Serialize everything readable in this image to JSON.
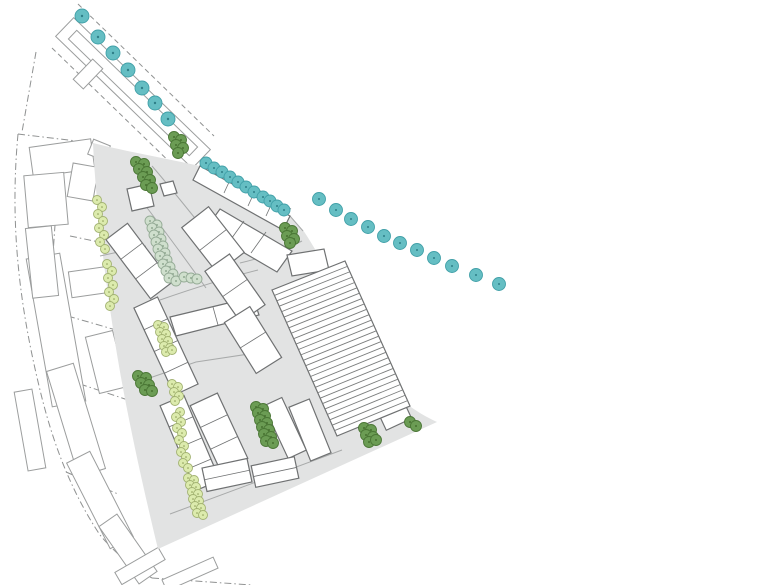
{
  "document": {
    "kind": "architectural-site-plan",
    "canvas": {
      "w": 780,
      "h": 585
    }
  },
  "palette": {
    "background": "#ffffff",
    "site_gray": "#e2e3e3",
    "street_line": "#a8aaaa",
    "context_outline": "#9b9d9d",
    "dash_line": "#8f9191",
    "building_outline": "#6f7172",
    "building_fill": "#ffffff",
    "hatch_line": "#7b7d7d",
    "teal_fill": "#65bec3",
    "teal_stroke": "#41a0a8",
    "teal_dot": "#2f7f88",
    "dark_green_fill": "#6b9c54",
    "dark_green_stroke": "#4a7635",
    "dark_green_dot": "#3c6426",
    "light_green_fill": "#dcead0",
    "light_green_fill2": "#dcebad",
    "light_green_stroke": "#a2b271",
    "light_green_dot": "#8a9a55",
    "sage_fill": "#cfdfcd",
    "sage_stroke": "#95ab96",
    "sage_dot": "#7d997f"
  },
  "plan": {
    "site_path": "M 93,143 C 128,152 165,158 200,166 L 290,216 L 303,230 C 322,258 342,300 360,342 C 374,376 398,404 437,422 L 158,549 C 146,500 128,420 118,360 C 108,300 96,212 93,143 Z",
    "streets": [
      "M 152,166 C 178,196 206,233 232,263",
      "M 132,188 C 158,222 182,254 206,288",
      "M 100,256 L 146,246",
      "M 160,300 C 200,286 230,277 258,270",
      "M 138,382 L 196,362 L 262,352",
      "M 290,216 L 303,231",
      "M 240,263 C 266,257 284,250 302,241",
      "M 170,514 L 342,450"
    ],
    "context": {
      "dashdot": [
        "M 18,134 C 10,220 18,300 40,390 C 52,440 70,490 100,535 C 115,553 132,567 152,578",
        "M 18,134 L 93,143",
        "M 152,578 L 252,585",
        "M 36,52 L 22,132",
        "M 60,152 L 50,298",
        "M 70,236 L 128,248",
        "M 54,312 L 116,330",
        "M 80,384 L 134,402",
        "M 66,472 L 118,494"
      ],
      "dashed": [
        "M 78,4 L 214,136",
        "M 52,48 L 180,172",
        "M 199,155 L 291,209"
      ],
      "rects": [
        {
          "cx": 133,
          "cy": 93,
          "w": 190,
          "h": 26,
          "r": 44
        },
        {
          "cx": 133,
          "cy": 93,
          "w": 168,
          "h": 12,
          "r": 44
        },
        {
          "cx": 88,
          "cy": 74,
          "w": 14,
          "h": 28,
          "r": 44
        },
        {
          "cx": 62,
          "cy": 158,
          "w": 62,
          "h": 30,
          "r": -8
        },
        {
          "cx": 46,
          "cy": 200,
          "w": 40,
          "h": 52,
          "r": -5
        },
        {
          "cx": 83,
          "cy": 182,
          "w": 26,
          "h": 34,
          "r": 10
        },
        {
          "cx": 99,
          "cy": 150,
          "w": 18,
          "h": 16,
          "r": 22
        },
        {
          "cx": 56,
          "cy": 330,
          "w": 34,
          "h": 150,
          "r": -10
        },
        {
          "cx": 42,
          "cy": 262,
          "w": 26,
          "h": 70,
          "r": -6
        },
        {
          "cx": 76,
          "cy": 420,
          "w": 28,
          "h": 110,
          "r": -17
        },
        {
          "cx": 100,
          "cy": 500,
          "w": 26,
          "h": 96,
          "r": -27
        },
        {
          "cx": 128,
          "cy": 549,
          "w": 22,
          "h": 70,
          "r": -35
        },
        {
          "cx": 90,
          "cy": 282,
          "w": 40,
          "h": 26,
          "r": -8
        },
        {
          "cx": 106,
          "cy": 362,
          "w": 28,
          "h": 58,
          "r": -14
        },
        {
          "cx": 140,
          "cy": 566,
          "w": 50,
          "h": 14,
          "r": -30
        },
        {
          "cx": 190,
          "cy": 574,
          "w": 56,
          "h": 12,
          "r": -24
        },
        {
          "cx": 30,
          "cy": 430,
          "w": 18,
          "h": 80,
          "r": -10
        }
      ]
    },
    "buildings": [
      {
        "kind": "poly",
        "points": "200,166 290,216 283,230 193,180",
        "lines": [
          [
            230,
            180,
            224,
            193
          ],
          [
            254,
            193,
            248,
            206
          ],
          [
            272,
            203,
            266,
            216
          ]
        ]
      },
      {
        "kind": "poly",
        "points": "220,209 292,251 277,272 205,230",
        "lines": [
          [
            244,
            221,
            229,
            242
          ],
          [
            266,
            232,
            251,
            253
          ]
        ]
      },
      {
        "kind": "poly",
        "points": "127,189 149,184 154,206 132,211",
        "lines": []
      },
      {
        "kind": "poly",
        "points": "160,184 173,181 177,193 164,196",
        "lines": []
      },
      {
        "kind": "poly",
        "points": "170,317 253,297 259,315 176,336",
        "lines": [
          [
            213,
            307,
            218,
            325
          ]
        ]
      },
      {
        "kind": "poly",
        "points": "287,255 324,249 329,270 292,276",
        "lines": []
      },
      {
        "kind": "rect",
        "cx": 139,
        "cy": 261,
        "w": 27,
        "h": 74,
        "r": -37,
        "div": 2
      },
      {
        "kind": "rect",
        "cx": 166,
        "cy": 346,
        "w": 26,
        "h": 96,
        "r": -25,
        "div": 3
      },
      {
        "kind": "rect",
        "cx": 190,
        "cy": 443,
        "w": 26,
        "h": 92,
        "r": -23,
        "div": 3
      },
      {
        "kind": "rect",
        "cx": 213,
        "cy": 240,
        "w": 34,
        "h": 58,
        "r": -38,
        "div": 1
      },
      {
        "kind": "rect",
        "cx": 235,
        "cy": 288,
        "w": 30,
        "h": 62,
        "r": -35,
        "div": 1
      },
      {
        "kind": "rect",
        "cx": 253,
        "cy": 340,
        "w": 30,
        "h": 60,
        "r": -32,
        "div": 1
      },
      {
        "kind": "rect",
        "cx": 219,
        "cy": 432,
        "w": 30,
        "h": 72,
        "r": -25,
        "div": 2
      },
      {
        "kind": "rect",
        "cx": 285,
        "cy": 428,
        "w": 20,
        "h": 58,
        "r": -25,
        "div": 0
      },
      {
        "kind": "rect",
        "cx": 227,
        "cy": 475,
        "w": 46,
        "h": 24,
        "r": -12,
        "div": 1
      },
      {
        "kind": "rect",
        "cx": 275,
        "cy": 472,
        "w": 44,
        "h": 22,
        "r": -12,
        "div": 1
      },
      {
        "kind": "rect",
        "cx": 310,
        "cy": 430,
        "w": 22,
        "h": 58,
        "r": -22,
        "div": 0
      },
      {
        "kind": "rect",
        "cx": 396,
        "cy": 418,
        "w": 28,
        "h": 14,
        "r": -25,
        "div": 0
      }
    ],
    "hall": {
      "left_edge": [
        [
          272,
          290
        ],
        [
          337,
          436
        ]
      ],
      "right_edge": [
        [
          345,
          261
        ],
        [
          410,
          406
        ]
      ],
      "stripes": 26
    },
    "trees": {
      "teal_street": {
        "r": 7,
        "dot": 1.2,
        "fill": "#65bec3",
        "stroke": "#41a0a8",
        "dotc": "#2f7f88",
        "pts": [
          [
            82,
            16
          ],
          [
            98,
            37
          ],
          [
            113,
            53
          ],
          [
            128,
            70
          ],
          [
            142,
            88
          ],
          [
            155,
            103
          ],
          [
            168,
            119
          ]
        ]
      },
      "teal_row": {
        "r": 6,
        "dot": 1,
        "fill": "#65bec3",
        "stroke": "#41a0a8",
        "dotc": "#2f7f88",
        "pts": [
          [
            206,
            163
          ],
          [
            214,
            168
          ],
          [
            222,
            172
          ],
          [
            230,
            177
          ],
          [
            238,
            182
          ],
          [
            246,
            187
          ],
          [
            254,
            192
          ],
          [
            263,
            197
          ],
          [
            270,
            201
          ],
          [
            277,
            206
          ],
          [
            284,
            210
          ]
        ]
      },
      "teal_arc": {
        "r": 6.5,
        "dot": 1,
        "fill": "#65bec3",
        "stroke": "#41a0a8",
        "dotc": "#2f7f88",
        "pts": [
          [
            319,
            199
          ],
          [
            336,
            210
          ],
          [
            351,
            219
          ],
          [
            368,
            227
          ],
          [
            384,
            236
          ],
          [
            400,
            243
          ],
          [
            417,
            250
          ],
          [
            434,
            258
          ],
          [
            452,
            266
          ],
          [
            476,
            275
          ],
          [
            499,
            284
          ]
        ]
      },
      "dark_green": {
        "r": 5.5,
        "dot": 0.9,
        "fill": "#6b9c54",
        "stroke": "#4a7635",
        "dotc": "#3c6426",
        "pts": [
          [
            174,
            137
          ],
          [
            181,
            140
          ],
          [
            176,
            145
          ],
          [
            183,
            148
          ],
          [
            178,
            153
          ],
          [
            136,
            162
          ],
          [
            144,
            164
          ],
          [
            139,
            169
          ],
          [
            147,
            172
          ],
          [
            143,
            177
          ],
          [
            150,
            180
          ],
          [
            146,
            185
          ],
          [
            152,
            188
          ],
          [
            285,
            228
          ],
          [
            292,
            231
          ],
          [
            287,
            236
          ],
          [
            294,
            239
          ],
          [
            290,
            243
          ],
          [
            138,
            376
          ],
          [
            146,
            378
          ],
          [
            141,
            383
          ],
          [
            149,
            385
          ],
          [
            145,
            390
          ],
          [
            152,
            391
          ],
          [
            256,
            407
          ],
          [
            263,
            409
          ],
          [
            258,
            413
          ],
          [
            265,
            416
          ],
          [
            260,
            420
          ],
          [
            267,
            423
          ],
          [
            262,
            427
          ],
          [
            269,
            430
          ],
          [
            264,
            434
          ],
          [
            271,
            437
          ],
          [
            266,
            441
          ],
          [
            273,
            443
          ],
          [
            364,
            428
          ],
          [
            371,
            430
          ],
          [
            366,
            435
          ],
          [
            373,
            437
          ],
          [
            369,
            442
          ],
          [
            376,
            440
          ],
          [
            410,
            422
          ],
          [
            416,
            426
          ]
        ]
      },
      "light_green": {
        "r": 4.5,
        "dot": 0.8,
        "fill": "#dcebad",
        "stroke": "#a2b271",
        "dotc": "#8a9a55",
        "pts": [
          [
            97,
            200
          ],
          [
            102,
            207
          ],
          [
            98,
            214
          ],
          [
            103,
            221
          ],
          [
            99,
            228
          ],
          [
            104,
            235
          ],
          [
            100,
            242
          ],
          [
            105,
            249
          ],
          [
            107,
            264
          ],
          [
            112,
            271
          ],
          [
            108,
            278
          ],
          [
            113,
            285
          ],
          [
            109,
            292
          ],
          [
            114,
            299
          ],
          [
            110,
            306
          ],
          [
            158,
            325
          ],
          [
            164,
            327
          ],
          [
            160,
            332
          ],
          [
            166,
            334
          ],
          [
            162,
            339
          ],
          [
            168,
            341
          ],
          [
            164,
            346
          ],
          [
            170,
            348
          ],
          [
            166,
            352
          ],
          [
            172,
            350
          ],
          [
            172,
            384
          ],
          [
            178,
            387
          ],
          [
            174,
            392
          ],
          [
            179,
            396
          ],
          [
            175,
            401
          ],
          [
            180,
            412
          ],
          [
            176,
            417
          ],
          [
            181,
            422
          ],
          [
            177,
            428
          ],
          [
            182,
            433
          ],
          [
            179,
            440
          ],
          [
            184,
            446
          ],
          [
            181,
            452
          ],
          [
            186,
            457
          ],
          [
            183,
            463
          ],
          [
            188,
            468
          ],
          [
            188,
            478
          ],
          [
            194,
            480
          ],
          [
            190,
            485
          ],
          [
            196,
            487
          ],
          [
            192,
            492
          ],
          [
            198,
            494
          ],
          [
            193,
            499
          ],
          [
            199,
            501
          ],
          [
            195,
            506
          ],
          [
            201,
            508
          ],
          [
            197,
            513
          ],
          [
            203,
            515
          ]
        ]
      },
      "sage": {
        "r": 5,
        "dot": 0.9,
        "fill": "#cfdfcd",
        "stroke": "#95ab96",
        "dotc": "#7d997f",
        "pts": [
          [
            150,
            221
          ],
          [
            157,
            225
          ],
          [
            152,
            228
          ],
          [
            159,
            232
          ],
          [
            154,
            235
          ],
          [
            161,
            239
          ],
          [
            156,
            242
          ],
          [
            163,
            246
          ],
          [
            158,
            249
          ],
          [
            165,
            253
          ],
          [
            160,
            256
          ],
          [
            167,
            260
          ],
          [
            163,
            264
          ],
          [
            170,
            267
          ],
          [
            166,
            271
          ],
          [
            173,
            274
          ],
          [
            169,
            278
          ],
          [
            176,
            281
          ],
          [
            184,
            277
          ],
          [
            191,
            278
          ],
          [
            197,
            279
          ]
        ]
      }
    }
  }
}
